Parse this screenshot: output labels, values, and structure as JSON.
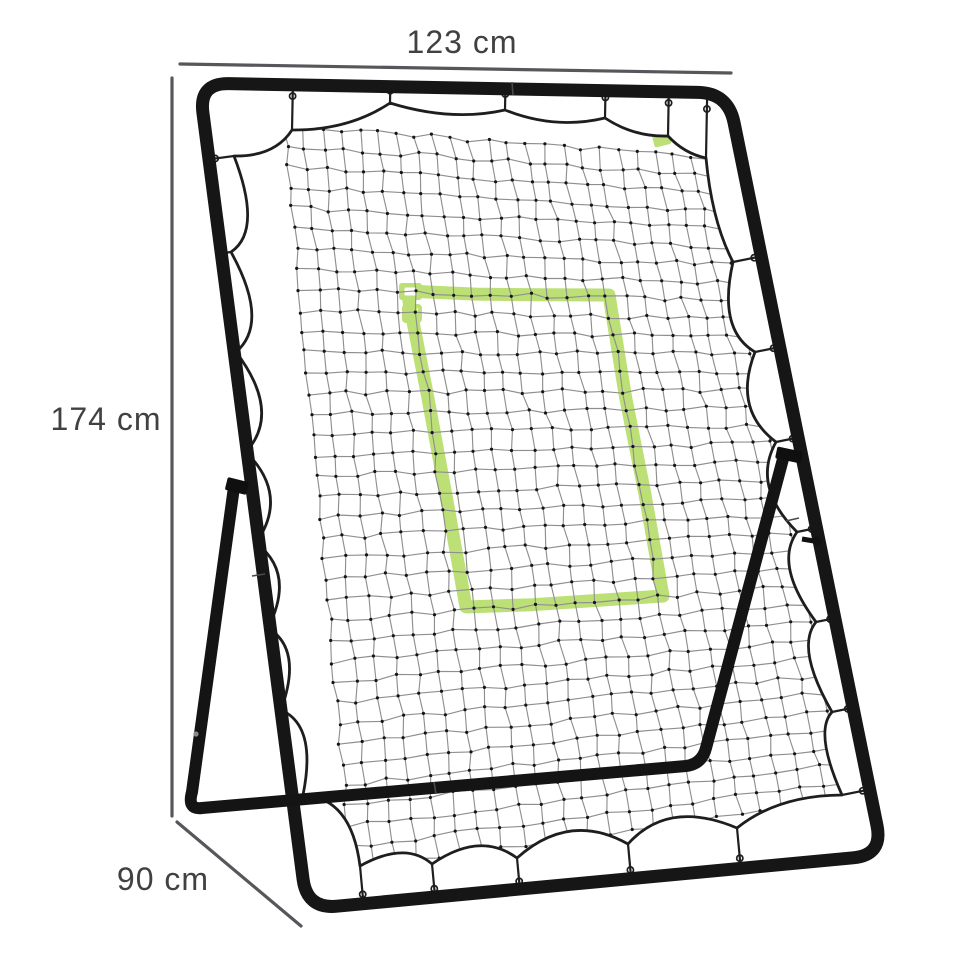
{
  "annotations": {
    "width_label": "123 cm",
    "height_label": "174 cm",
    "depth_label": "90 cm"
  },
  "colors": {
    "background": "#ffffff",
    "frame_black": "#161616",
    "support_black": "#141414",
    "net_cord": "#1e1e1e",
    "mesh_line": "#8f8f8f",
    "mesh_knot": "#151515",
    "target_green": "#bce076",
    "dimension_line": "#56575a",
    "label_text": "#414042"
  }
}
